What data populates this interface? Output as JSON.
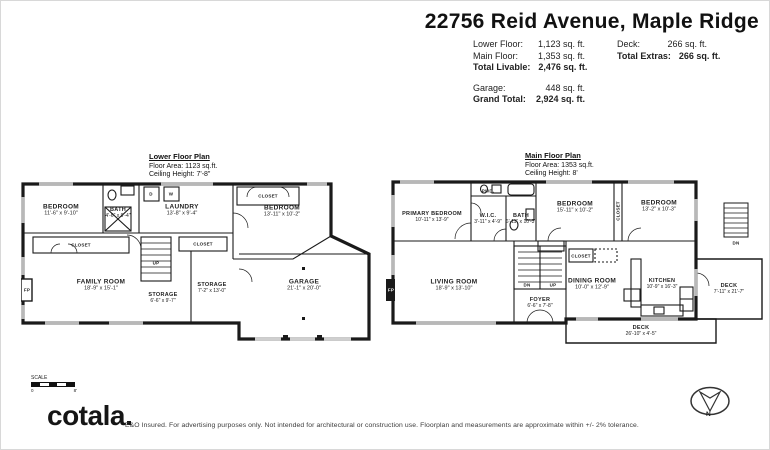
{
  "header": {
    "title": "22756 Reid Avenue, Maple Ridge",
    "stats_left": {
      "lower_label": "Lower Floor:",
      "lower_value": "1,123 sq. ft.",
      "main_label": "Main Floor:",
      "main_value": "1,353 sq. ft.",
      "livable_label": "Total Livable:",
      "livable_value": "2,476 sq. ft.",
      "garage_label": "Garage:",
      "garage_value": "448 sq. ft.",
      "grand_label": "Grand Total:",
      "grand_value": "2,924 sq. ft."
    },
    "stats_right": {
      "deck_label": "Deck:",
      "deck_value": "266 sq. ft.",
      "extras_label": "Total Extras:",
      "extras_value": "266 sq. ft."
    }
  },
  "lower": {
    "title": "Lower Floor Plan",
    "area": "Floor Area: 1123 sq.ft.",
    "ceiling": "Ceiling Height: 7'-8\"",
    "rooms": [
      {
        "name": "BEDROOM",
        "dims": "11'-6\" x 9'-10\""
      },
      {
        "name": "BATH",
        "dims": "4'-6\" x 9'-4\""
      },
      {
        "name": "LAUNDRY",
        "dims": "13'-8\" x 9'-4\""
      },
      {
        "name": "BEDROOM",
        "dims": "13'-11\" x 10'-2\""
      },
      {
        "name": "FAMILY ROOM",
        "dims": "18'-9\" x 15'-1\""
      },
      {
        "name": "STORAGE",
        "dims": "6'-6\" x 9'-7\""
      },
      {
        "name": "STORAGE",
        "dims": "7'-2\" x 13'-0\""
      },
      {
        "name": "GARAGE",
        "dims": "21'-1\" x 20'-0\""
      }
    ],
    "labels": {
      "closet": "CLOSET",
      "fp": "FP",
      "dryer": "D",
      "washer": "W",
      "up": "UP"
    }
  },
  "main": {
    "title": "Main Floor Plan",
    "area": "Floor Area: 1353 sq.ft.",
    "ceiling": "Ceiling Height: 8'",
    "rooms": [
      {
        "name": "PRIMARY BEDROOM",
        "dims": "10'-11\" x 13'-9\""
      },
      {
        "name": "W.I.C.",
        "dims": "3'-11\" x 4'-9\""
      },
      {
        "name": "BATH",
        "dims": "6'-11\" x 10'-3\""
      },
      {
        "name": "BEDROOM",
        "dims": "15'-11\" x 10'-2\""
      },
      {
        "name": "BEDROOM",
        "dims": "13'-2\" x 10'-3\""
      },
      {
        "name": "LIVING ROOM",
        "dims": "18'-9\" x 13'-10\""
      },
      {
        "name": "FOYER",
        "dims": "6'-6\" x 7'-8\""
      },
      {
        "name": "DINING ROOM",
        "dims": "10'-0\" x 12'-9\""
      },
      {
        "name": "KITCHEN",
        "dims": "10'-9\" x 16'-3\""
      },
      {
        "name": "DECK",
        "dims": "7'-11\" x 21'-7\""
      },
      {
        "name": "DECK",
        "dims": "26'-10\" x 4'-5\""
      }
    ],
    "labels": {
      "pwd": "PWD.",
      "closet": "CLOSET",
      "fp": "FP",
      "up": "UP",
      "dn": "DN"
    }
  },
  "footer": {
    "logo": "cotala",
    "disclaimer": "E&O Insured. For advertising purposes only. Not intended for architectural or construction use. Floorplan and measurements are approximate within +/- 2% tolerance.",
    "scale_label": "SCALE",
    "scale_start": "0",
    "scale_end": "8'",
    "compass_n": "N"
  }
}
